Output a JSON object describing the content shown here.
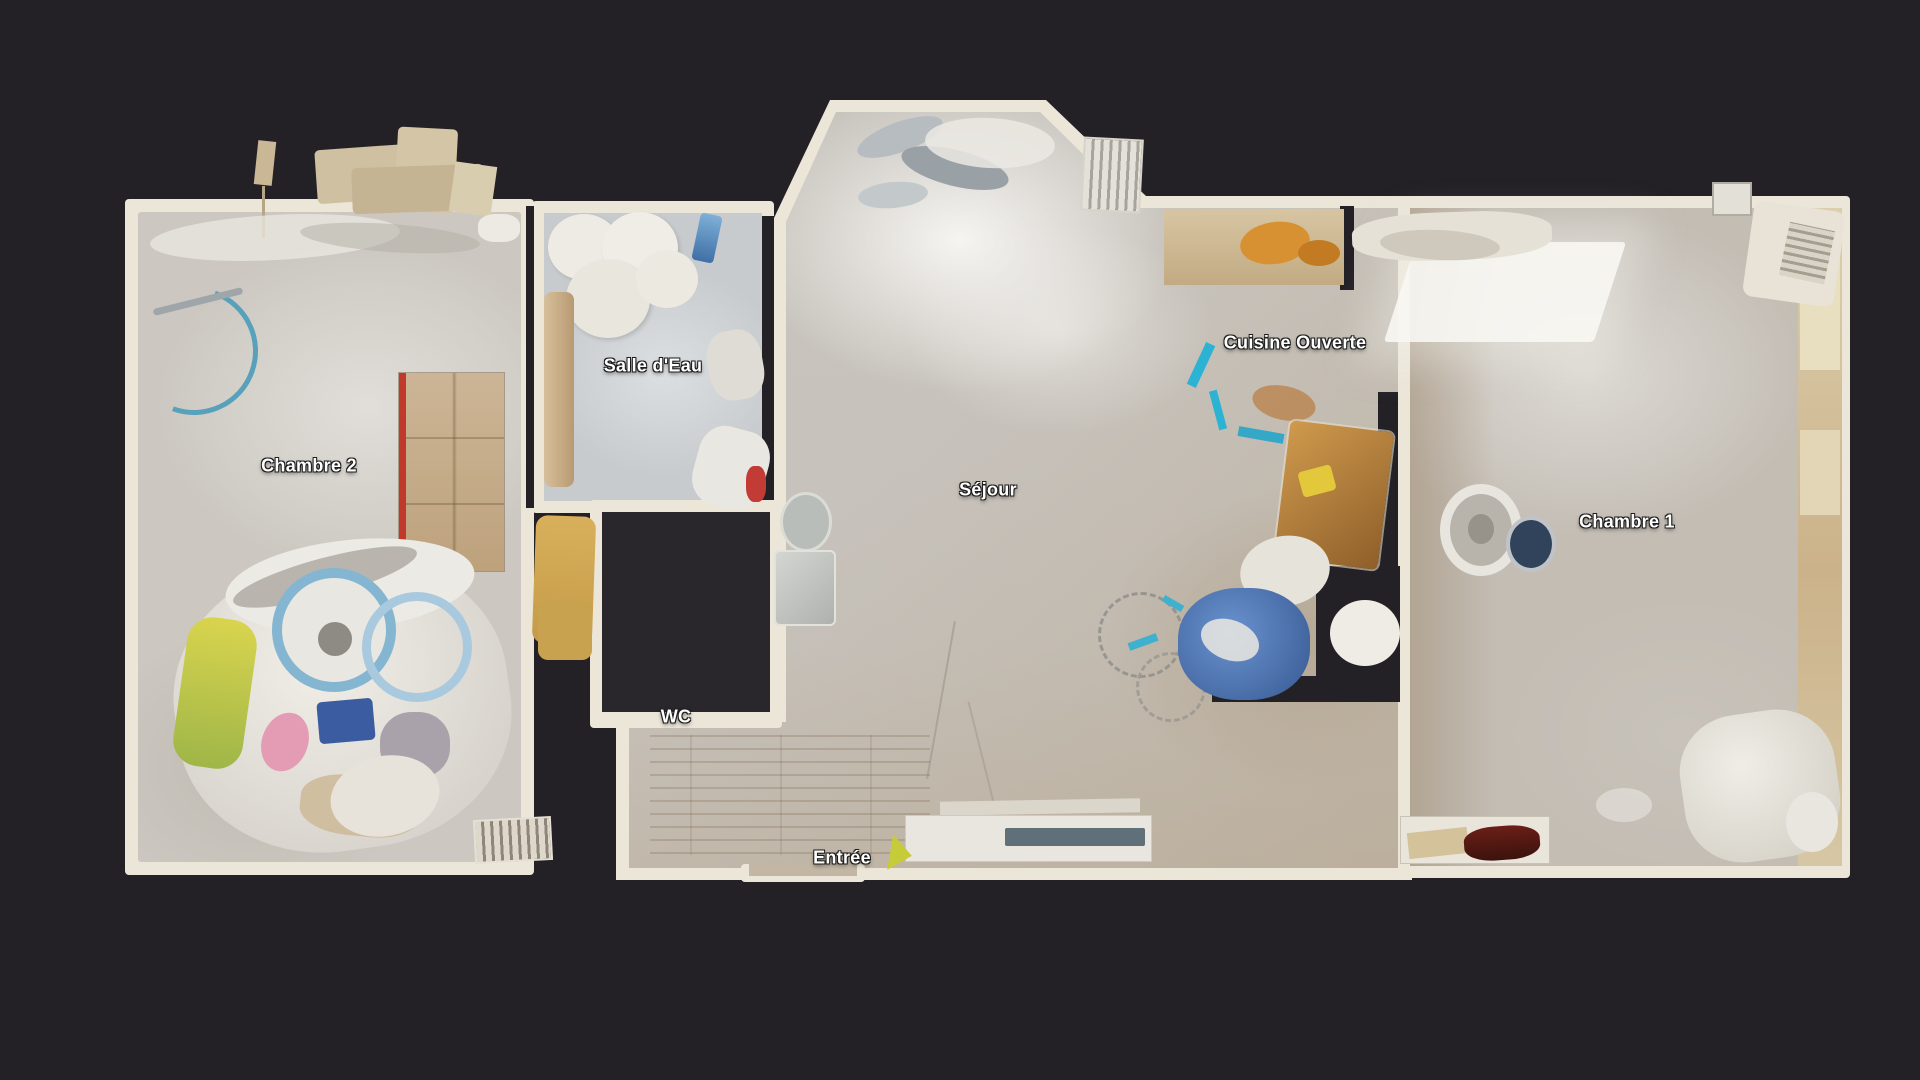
{
  "scene": {
    "view": "floorplan-top-view",
    "background_color": "#232126",
    "wall_color": "#ece6d9",
    "unscanned_color": "#29272b",
    "label_color": "#ffffff",
    "label_outline_color": "#1c1c1c",
    "accent_colors": {
      "cable_blue": "#57a1ba",
      "tarp_blue": "#5585c8",
      "paint_cyan": "#2cb3d4",
      "wood_orange": "#c98e44",
      "wardrobe_red": "#c0392b",
      "right_wall_beige": "#d5c6a4"
    }
  },
  "floorplan": {
    "rooms": [
      {
        "id": "chambre-2",
        "label": "Chambre 2"
      },
      {
        "id": "salle-deau",
        "label": "Salle d'Eau"
      },
      {
        "id": "sejour",
        "label": "Séjour"
      },
      {
        "id": "cuisine-ouverte",
        "label": "Cuisine Ouverte"
      },
      {
        "id": "chambre-1",
        "label": "Chambre 1"
      },
      {
        "id": "wc",
        "label": "WC"
      },
      {
        "id": "entree",
        "label": "Entrée"
      }
    ]
  }
}
